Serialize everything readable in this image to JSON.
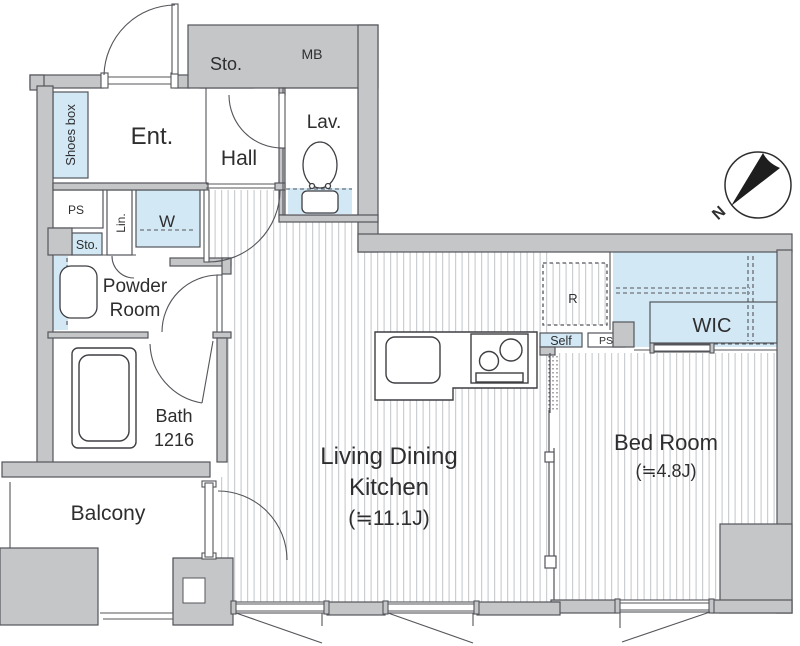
{
  "title": "Apartment floor plan (1LDK)",
  "colors": {
    "wall_fill": "#c5c6c8",
    "line": "#54555a",
    "accent_blue": "#d2e8f4",
    "stripe": "#cbcfd2",
    "needle": "#1e1e1e"
  },
  "rooms": {
    "entrance": "Ent.",
    "hall": "Hall",
    "lavatory": "Lav.",
    "storage_top": "Sto.",
    "meter_box": "MB",
    "shoes_box": "Shoes box",
    "pipe_space": "PS",
    "linen": "Lin.",
    "washer": "W",
    "storage_small": "Sto.",
    "powder_line1": "Powder",
    "powder_line2": "Room",
    "bath_line1": "Bath",
    "bath_line2": "1216",
    "balcony": "Balcony",
    "ldk_line1": "Living Dining",
    "ldk_line2": "Kitchen",
    "ldk_size": "(≒11.1J)",
    "bedroom_line1": "Bed Room",
    "bedroom_size": "(≒4.8J)",
    "wic": "WIC",
    "refrigerator": "R",
    "shelf": "Self",
    "pipe_space2": "PS"
  },
  "compass": {
    "north_label": "N"
  }
}
